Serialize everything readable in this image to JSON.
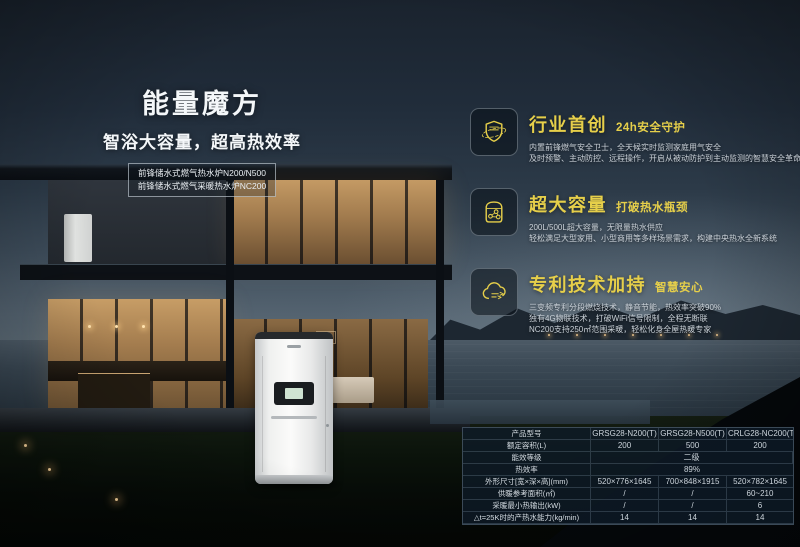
{
  "poster": {
    "title": "能量魔方",
    "subtitle": "智浴大容量，超高热效率",
    "product_lines": {
      "line1": "前锋储水式燃气热水炉N200/N500",
      "line2": "前锋储水式燃气采暖热水炉NC200"
    },
    "features": [
      {
        "icon": "shield-orbit-icon",
        "heading": "行业首创",
        "tagline": "24h安全守护",
        "desc_lines": [
          "内置前锋燃气安全卫士，全天候实时监测家庭用气安全",
          "及时预警、主动防控、远程操作，开启从被动防护到主动监测的智慧安全革命"
        ]
      },
      {
        "icon": "water-tank-icon",
        "heading": "超大容量",
        "tagline": "打破热水瓶颈",
        "desc_lines": [
          "200L/500L超大容量，无限量热水供应",
          "轻松满足大型家用、小型商用等多样场景需求，构建中央热水全新系统"
        ]
      },
      {
        "icon": "cloud-link-icon",
        "heading": "专利技术加持",
        "tagline": "智慧安心",
        "desc_lines": [
          "三变频专利分段燃烧技术，静音节能，热效率突破90%",
          "独有4G物联技术，打破WiFi信号限制，全程无断联",
          "NC200支持250㎡范围采暖，轻松化身全屋热暖专家"
        ]
      }
    ],
    "spec_table": {
      "rows": [
        {
          "label": "产品型号",
          "values": [
            "GRSG28-N200(T)",
            "GRSG28-N500(T)",
            "CRLG28-NC200(T)"
          ]
        },
        {
          "label": "额定容积(L)",
          "values": [
            "200",
            "500",
            "200"
          ]
        },
        {
          "label": "能效等级",
          "values": [
            "二级"
          ]
        },
        {
          "label": "热效率",
          "values": [
            "89%"
          ]
        },
        {
          "label": "外形尺寸[宽×深×高](mm)",
          "values": [
            "520×776×1645",
            "700×848×1915",
            "520×782×1645"
          ]
        },
        {
          "label": "供暖参考面积(㎡)",
          "values": [
            "/",
            "/",
            "60~210"
          ]
        },
        {
          "label": "采暖最小热输出(kW)",
          "values": [
            "/",
            "/",
            "6"
          ]
        },
        {
          "label": "△t=25K时的产热水能力(kg/min)",
          "values": [
            "14",
            "14",
            "14"
          ]
        }
      ]
    },
    "colors": {
      "accent_yellow": "#e6cf4a",
      "headline_white": "#f4f7f9",
      "desc_grey": "#cad1d8",
      "table_bg": "#0e1b28"
    }
  }
}
